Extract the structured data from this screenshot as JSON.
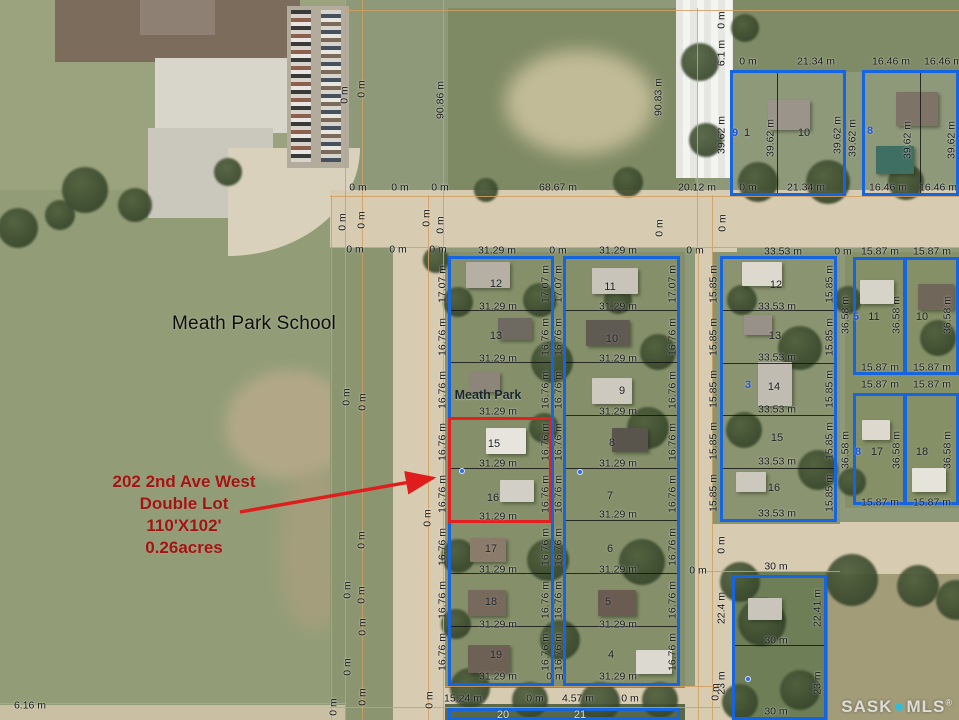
{
  "colors": {
    "blue": "#1565e0",
    "red": "#e31f1f",
    "arrow": "#e01d1d",
    "grid": "#d0a061",
    "annotation": "#a51212",
    "watermark_dot": "#33bcd9"
  },
  "school_label": "Meath Park School",
  "park_label": "Meath Park",
  "annotation": {
    "l1": "202 2nd Ave West",
    "l2": "Double Lot",
    "l3": "110'X102'",
    "l4": "0.26acres"
  },
  "watermark": {
    "sask": "SASK",
    "mls": "MLS",
    "reg": "®"
  },
  "arrow": {
    "x1": 240,
    "y1": 512,
    "x2": 433,
    "y2": 478
  },
  "red_highlight": {
    "x": 448,
    "y": 417,
    "w": 104,
    "h": 106
  },
  "blue_blocks": [
    {
      "x": 448,
      "y": 256,
      "w": 106,
      "h": 430
    },
    {
      "x": 563,
      "y": 256,
      "w": 117,
      "h": 430
    },
    {
      "x": 720,
      "y": 256,
      "w": 117,
      "h": 266
    },
    {
      "x": 730,
      "y": 70,
      "w": 116,
      "h": 126
    },
    {
      "x": 862,
      "y": 70,
      "w": 97,
      "h": 126
    },
    {
      "x": 853,
      "y": 257,
      "w": 53,
      "h": 118
    },
    {
      "x": 904,
      "y": 257,
      "w": 55,
      "h": 118
    },
    {
      "x": 853,
      "y": 393,
      "w": 53,
      "h": 112
    },
    {
      "x": 904,
      "y": 393,
      "w": 55,
      "h": 112
    },
    {
      "x": 732,
      "y": 575,
      "w": 95,
      "h": 145
    },
    {
      "x": 448,
      "y": 708,
      "w": 232,
      "h": 12
    }
  ],
  "grid_lines": [
    {
      "x": 345,
      "y": 0,
      "w": 1,
      "h": 720
    },
    {
      "x": 362,
      "y": 0,
      "w": 1,
      "h": 720
    },
    {
      "x": 331,
      "y": 195,
      "w": 1,
      "h": 525
    },
    {
      "x": 428,
      "y": 195,
      "w": 1,
      "h": 525
    },
    {
      "x": 443,
      "y": 0,
      "w": 1,
      "h": 720
    },
    {
      "x": 697,
      "y": 8,
      "w": 1,
      "h": 240
    },
    {
      "x": 698,
      "y": 248,
      "w": 1,
      "h": 472
    },
    {
      "x": 712,
      "y": 195,
      "w": 1,
      "h": 525
    },
    {
      "x": 345,
      "y": 10,
      "w": 614,
      "h": 1
    },
    {
      "x": 330,
      "y": 196,
      "w": 629,
      "h": 1
    },
    {
      "x": 330,
      "y": 247,
      "w": 629,
      "h": 1
    },
    {
      "x": 445,
      "y": 686,
      "w": 275,
      "h": 1
    },
    {
      "x": 330,
      "y": 707,
      "w": 390,
      "h": 1
    },
    {
      "x": 0,
      "y": 703,
      "w": 345,
      "h": 1
    },
    {
      "x": 700,
      "y": 571,
      "w": 140,
      "h": 1
    }
  ],
  "lot_dividers": [
    {
      "x": 448,
      "y": 310,
      "w": 106,
      "h": 1
    },
    {
      "x": 448,
      "y": 362,
      "w": 106,
      "h": 1
    },
    {
      "x": 450,
      "y": 468,
      "w": 102,
      "h": 1
    },
    {
      "x": 448,
      "y": 520,
      "w": 106,
      "h": 1
    },
    {
      "x": 448,
      "y": 573,
      "w": 106,
      "h": 1
    },
    {
      "x": 448,
      "y": 626,
      "w": 106,
      "h": 1
    },
    {
      "x": 563,
      "y": 310,
      "w": 117,
      "h": 1
    },
    {
      "x": 563,
      "y": 362,
      "w": 117,
      "h": 1
    },
    {
      "x": 563,
      "y": 415,
      "w": 117,
      "h": 1
    },
    {
      "x": 563,
      "y": 468,
      "w": 117,
      "h": 1
    },
    {
      "x": 563,
      "y": 520,
      "w": 117,
      "h": 1
    },
    {
      "x": 563,
      "y": 573,
      "w": 117,
      "h": 1
    },
    {
      "x": 563,
      "y": 626,
      "w": 117,
      "h": 1
    },
    {
      "x": 720,
      "y": 310,
      "w": 117,
      "h": 1
    },
    {
      "x": 720,
      "y": 363,
      "w": 117,
      "h": 1
    },
    {
      "x": 720,
      "y": 415,
      "w": 117,
      "h": 1
    },
    {
      "x": 720,
      "y": 468,
      "w": 117,
      "h": 1
    },
    {
      "x": 777,
      "y": 72,
      "w": 1,
      "h": 124
    },
    {
      "x": 920,
      "y": 72,
      "w": 1,
      "h": 124
    },
    {
      "x": 905,
      "y": 258,
      "w": 1,
      "h": 116
    },
    {
      "x": 905,
      "y": 394,
      "w": 1,
      "h": 110
    },
    {
      "x": 732,
      "y": 645,
      "w": 95,
      "h": 1
    }
  ],
  "measurement_labels": [
    {
      "t": "0 m",
      "x": 345,
      "y": 95,
      "r": 1
    },
    {
      "t": "0 m",
      "x": 362,
      "y": 89,
      "r": 1
    },
    {
      "t": "90.86 m",
      "x": 441,
      "y": 100,
      "r": 1
    },
    {
      "t": "90.83 m",
      "x": 659,
      "y": 97,
      "r": 1
    },
    {
      "t": "0 m",
      "x": 722,
      "y": 20,
      "r": 1
    },
    {
      "t": "6.1 m",
      "x": 722,
      "y": 53,
      "r": 1
    },
    {
      "t": "0 m",
      "x": 748,
      "y": 62
    },
    {
      "t": "21.34 m",
      "x": 816,
      "y": 62
    },
    {
      "t": "16.46 m",
      "x": 891,
      "y": 62
    },
    {
      "t": "16.46 m",
      "x": 943,
      "y": 62
    },
    {
      "t": "39.62 m",
      "x": 722,
      "y": 135,
      "r": 1
    },
    {
      "t": "39.62 m",
      "x": 771,
      "y": 138,
      "r": 1
    },
    {
      "t": "39.62 m",
      "x": 838,
      "y": 135,
      "r": 1
    },
    {
      "t": "39.62 m",
      "x": 853,
      "y": 138,
      "r": 1
    },
    {
      "t": "39.62 m",
      "x": 908,
      "y": 140,
      "r": 1
    },
    {
      "t": "39.62 m",
      "x": 952,
      "y": 140,
      "r": 1
    },
    {
      "t": "0 m",
      "x": 358,
      "y": 188
    },
    {
      "t": "0 m",
      "x": 400,
      "y": 188
    },
    {
      "t": "0 m",
      "x": 440,
      "y": 188
    },
    {
      "t": "68.67 m",
      "x": 558,
      "y": 188
    },
    {
      "t": "20.12 m",
      "x": 697,
      "y": 188
    },
    {
      "t": "0 m",
      "x": 748,
      "y": 188
    },
    {
      "t": "21.34 m",
      "x": 806,
      "y": 188
    },
    {
      "t": "16.46 m",
      "x": 888,
      "y": 188
    },
    {
      "t": "16.46 m",
      "x": 938,
      "y": 188
    },
    {
      "t": "0 m",
      "x": 343,
      "y": 222,
      "r": 1
    },
    {
      "t": "0 m",
      "x": 362,
      "y": 220,
      "r": 1
    },
    {
      "t": "0 m",
      "x": 427,
      "y": 218,
      "r": 1
    },
    {
      "t": "0 m",
      "x": 441,
      "y": 225,
      "r": 1
    },
    {
      "t": "0 m",
      "x": 660,
      "y": 228,
      "r": 1
    },
    {
      "t": "0 m",
      "x": 723,
      "y": 223,
      "r": 1
    },
    {
      "t": "0 m",
      "x": 355,
      "y": 250
    },
    {
      "t": "0 m",
      "x": 398,
      "y": 250
    },
    {
      "t": "0 m",
      "x": 438,
      "y": 250
    },
    {
      "t": "31.29 m",
      "x": 497,
      "y": 251
    },
    {
      "t": "0 m",
      "x": 558,
      "y": 251
    },
    {
      "t": "31.29 m",
      "x": 618,
      "y": 251
    },
    {
      "t": "0 m",
      "x": 695,
      "y": 251
    },
    {
      "t": "33.53 m",
      "x": 783,
      "y": 252
    },
    {
      "t": "0 m",
      "x": 843,
      "y": 252
    },
    {
      "t": "15.87 m",
      "x": 880,
      "y": 252
    },
    {
      "t": "15.87 m",
      "x": 932,
      "y": 252
    },
    {
      "t": "31.29 m",
      "x": 498,
      "y": 307
    },
    {
      "t": "31.29 m",
      "x": 498,
      "y": 359
    },
    {
      "t": "31.29 m",
      "x": 498,
      "y": 412
    },
    {
      "t": "31.29 m",
      "x": 498,
      "y": 464
    },
    {
      "t": "31.29 m",
      "x": 498,
      "y": 517
    },
    {
      "t": "31.29 m",
      "x": 498,
      "y": 570
    },
    {
      "t": "31.29 m",
      "x": 498,
      "y": 625
    },
    {
      "t": "31.29 m",
      "x": 498,
      "y": 677
    },
    {
      "t": "31.29 m",
      "x": 618,
      "y": 307
    },
    {
      "t": "31.29 m",
      "x": 618,
      "y": 359
    },
    {
      "t": "31.29 m",
      "x": 618,
      "y": 412
    },
    {
      "t": "31.29 m",
      "x": 618,
      "y": 464
    },
    {
      "t": "31.29 m",
      "x": 618,
      "y": 515
    },
    {
      "t": "31.29 m",
      "x": 618,
      "y": 570
    },
    {
      "t": "31.29 m",
      "x": 618,
      "y": 625
    },
    {
      "t": "31.29 m",
      "x": 618,
      "y": 677
    },
    {
      "t": "33.53 m",
      "x": 777,
      "y": 307
    },
    {
      "t": "33.53 m",
      "x": 777,
      "y": 358
    },
    {
      "t": "33.53 m",
      "x": 777,
      "y": 410
    },
    {
      "t": "33.53 m",
      "x": 777,
      "y": 462
    },
    {
      "t": "33.53 m",
      "x": 777,
      "y": 514
    },
    {
      "t": "17.07 m",
      "x": 443,
      "y": 284,
      "r": 1
    },
    {
      "t": "16.76 m",
      "x": 443,
      "y": 337,
      "r": 1
    },
    {
      "t": "16.76 m",
      "x": 443,
      "y": 390,
      "r": 1
    },
    {
      "t": "16.76 m",
      "x": 443,
      "y": 442,
      "r": 1
    },
    {
      "t": "16.76 m",
      "x": 443,
      "y": 494,
      "r": 1
    },
    {
      "t": "16.76 m",
      "x": 443,
      "y": 547,
      "r": 1
    },
    {
      "t": "16.76 m",
      "x": 443,
      "y": 600,
      "r": 1
    },
    {
      "t": "16.76 m",
      "x": 443,
      "y": 652,
      "r": 1
    },
    {
      "t": "17.07 m",
      "x": 546,
      "y": 284,
      "r": 1
    },
    {
      "t": "16.76 m",
      "x": 546,
      "y": 337,
      "r": 1
    },
    {
      "t": "16.76 m",
      "x": 546,
      "y": 390,
      "r": 1
    },
    {
      "t": "16.76 m",
      "x": 546,
      "y": 442,
      "r": 1
    },
    {
      "t": "16.76 m",
      "x": 546,
      "y": 494,
      "r": 1
    },
    {
      "t": "16.76 m",
      "x": 546,
      "y": 547,
      "r": 1
    },
    {
      "t": "16.76 m",
      "x": 546,
      "y": 600,
      "r": 1
    },
    {
      "t": "16.76 m",
      "x": 546,
      "y": 652,
      "r": 1
    },
    {
      "t": "17.07 m",
      "x": 559,
      "y": 284,
      "r": 1
    },
    {
      "t": "16.76 m",
      "x": 559,
      "y": 337,
      "r": 1
    },
    {
      "t": "16.76 m",
      "x": 559,
      "y": 390,
      "r": 1
    },
    {
      "t": "16.76 m",
      "x": 559,
      "y": 442,
      "r": 1
    },
    {
      "t": "16.76 m",
      "x": 559,
      "y": 494,
      "r": 1
    },
    {
      "t": "16.76 m",
      "x": 559,
      "y": 547,
      "r": 1
    },
    {
      "t": "16.76 m",
      "x": 559,
      "y": 600,
      "r": 1
    },
    {
      "t": "16.76 m",
      "x": 559,
      "y": 652,
      "r": 1
    },
    {
      "t": "17.07 m",
      "x": 673,
      "y": 284,
      "r": 1
    },
    {
      "t": "16.76 m",
      "x": 673,
      "y": 337,
      "r": 1
    },
    {
      "t": "16.76 m",
      "x": 673,
      "y": 390,
      "r": 1
    },
    {
      "t": "16.76 m",
      "x": 673,
      "y": 442,
      "r": 1
    },
    {
      "t": "16.76 m",
      "x": 673,
      "y": 494,
      "r": 1
    },
    {
      "t": "16.76 m",
      "x": 673,
      "y": 547,
      "r": 1
    },
    {
      "t": "16.76 m",
      "x": 673,
      "y": 600,
      "r": 1
    },
    {
      "t": "16.76 m",
      "x": 673,
      "y": 652,
      "r": 1
    },
    {
      "t": "15.85 m",
      "x": 714,
      "y": 284,
      "r": 1
    },
    {
      "t": "15.85 m",
      "x": 714,
      "y": 337,
      "r": 1
    },
    {
      "t": "15.85 m",
      "x": 714,
      "y": 389,
      "r": 1
    },
    {
      "t": "15.85 m",
      "x": 714,
      "y": 441,
      "r": 1
    },
    {
      "t": "15.85 m",
      "x": 714,
      "y": 493,
      "r": 1
    },
    {
      "t": "15.85 m",
      "x": 830,
      "y": 284,
      "r": 1
    },
    {
      "t": "15.85 m",
      "x": 830,
      "y": 337,
      "r": 1
    },
    {
      "t": "15.85 m",
      "x": 830,
      "y": 389,
      "r": 1
    },
    {
      "t": "15.85 m",
      "x": 830,
      "y": 441,
      "r": 1
    },
    {
      "t": "15.85 m",
      "x": 830,
      "y": 493,
      "r": 1
    },
    {
      "t": "36.58 m",
      "x": 846,
      "y": 315,
      "r": 1
    },
    {
      "t": "36.58 m",
      "x": 897,
      "y": 315,
      "r": 1
    },
    {
      "t": "36.58 m",
      "x": 948,
      "y": 315,
      "r": 1
    },
    {
      "t": "36.58 m",
      "x": 846,
      "y": 450,
      "r": 1
    },
    {
      "t": "36.58 m",
      "x": 897,
      "y": 450,
      "r": 1
    },
    {
      "t": "36.58 m",
      "x": 948,
      "y": 450,
      "r": 1
    },
    {
      "t": "15.87 m",
      "x": 880,
      "y": 368
    },
    {
      "t": "15.87 m",
      "x": 932,
      "y": 368
    },
    {
      "t": "15.87 m",
      "x": 880,
      "y": 385
    },
    {
      "t": "15.87 m",
      "x": 932,
      "y": 385
    },
    {
      "t": "15.87 m",
      "x": 880,
      "y": 503
    },
    {
      "t": "15.87 m",
      "x": 932,
      "y": 503
    },
    {
      "t": "0 m",
      "x": 347,
      "y": 397,
      "r": 1
    },
    {
      "t": "0 m",
      "x": 363,
      "y": 402,
      "r": 1
    },
    {
      "t": "0 m",
      "x": 428,
      "y": 518,
      "r": 1
    },
    {
      "t": "0 m",
      "x": 362,
      "y": 540,
      "r": 1
    },
    {
      "t": "0 m",
      "x": 348,
      "y": 590,
      "r": 1
    },
    {
      "t": "0 m",
      "x": 362,
      "y": 595,
      "r": 1
    },
    {
      "t": "0 m",
      "x": 363,
      "y": 627,
      "r": 1
    },
    {
      "t": "0 m",
      "x": 348,
      "y": 667,
      "r": 1
    },
    {
      "t": "0 m",
      "x": 363,
      "y": 697,
      "r": 1
    },
    {
      "t": "0 m",
      "x": 430,
      "y": 700,
      "r": 1
    },
    {
      "t": "0 m",
      "x": 334,
      "y": 707,
      "r": 1
    },
    {
      "t": "0 m",
      "x": 722,
      "y": 545,
      "r": 1
    },
    {
      "t": "30 m",
      "x": 776,
      "y": 567
    },
    {
      "t": "22.4 m",
      "x": 722,
      "y": 608,
      "r": 1
    },
    {
      "t": "22.41 m",
      "x": 818,
      "y": 608,
      "r": 1
    },
    {
      "t": "30 m",
      "x": 776,
      "y": 641
    },
    {
      "t": "23 m",
      "x": 722,
      "y": 683,
      "r": 1
    },
    {
      "t": "23 m",
      "x": 818,
      "y": 683,
      "r": 1
    },
    {
      "t": "30 m",
      "x": 776,
      "y": 712
    },
    {
      "t": "0 m",
      "x": 555,
      "y": 677
    },
    {
      "t": "0 m",
      "x": 698,
      "y": 571
    },
    {
      "t": "15.24 m",
      "x": 463,
      "y": 699
    },
    {
      "t": "0 m",
      "x": 535,
      "y": 699
    },
    {
      "t": "4.57 m",
      "x": 578,
      "y": 699
    },
    {
      "t": "0 m",
      "x": 630,
      "y": 699
    },
    {
      "t": "0 m",
      "x": 716,
      "y": 692,
      "r": 1
    },
    {
      "t": "6.16 m",
      "x": 30,
      "y": 706
    }
  ],
  "lot_numbers": [
    {
      "t": "12",
      "x": 496,
      "y": 284
    },
    {
      "t": "13",
      "x": 496,
      "y": 336
    },
    {
      "t": "15",
      "x": 494,
      "y": 444
    },
    {
      "t": "16",
      "x": 493,
      "y": 498
    },
    {
      "t": "17",
      "x": 491,
      "y": 549
    },
    {
      "t": "18",
      "x": 491,
      "y": 602
    },
    {
      "t": "19",
      "x": 496,
      "y": 655
    },
    {
      "t": "11",
      "x": 610,
      "y": 287
    },
    {
      "t": "10",
      "x": 612,
      "y": 339
    },
    {
      "t": "9",
      "x": 622,
      "y": 391
    },
    {
      "t": "8",
      "x": 612,
      "y": 443
    },
    {
      "t": "7",
      "x": 610,
      "y": 496
    },
    {
      "t": "6",
      "x": 610,
      "y": 549
    },
    {
      "t": "5",
      "x": 608,
      "y": 602
    },
    {
      "t": "4",
      "x": 611,
      "y": 655
    },
    {
      "t": "12",
      "x": 776,
      "y": 285
    },
    {
      "t": "13",
      "x": 775,
      "y": 336
    },
    {
      "t": "14",
      "x": 774,
      "y": 387
    },
    {
      "t": "15",
      "x": 777,
      "y": 438
    },
    {
      "t": "16",
      "x": 774,
      "y": 488
    },
    {
      "t": "1",
      "x": 747,
      "y": 133
    },
    {
      "t": "10",
      "x": 804,
      "y": 133
    },
    {
      "t": "11",
      "x": 874,
      "y": 317
    },
    {
      "t": "10",
      "x": 922,
      "y": 317
    },
    {
      "t": "17",
      "x": 877,
      "y": 452
    },
    {
      "t": "18",
      "x": 922,
      "y": 452
    },
    {
      "t": "20",
      "x": 503,
      "y": 715,
      "light": 1
    },
    {
      "t": "21",
      "x": 580,
      "y": 715,
      "light": 1
    }
  ],
  "markers": [
    {
      "t": "9",
      "x": 735,
      "y": 133
    },
    {
      "t": "8",
      "x": 870,
      "y": 131
    },
    {
      "t": "5",
      "x": 856,
      "y": 317
    },
    {
      "t": "8",
      "x": 858,
      "y": 452
    },
    {
      "t": "3",
      "x": 748,
      "y": 385
    },
    {
      "t": "•",
      "x": 462,
      "y": 471
    },
    {
      "t": "•",
      "x": 580,
      "y": 472
    },
    {
      "t": "•",
      "x": 748,
      "y": 679
    }
  ]
}
